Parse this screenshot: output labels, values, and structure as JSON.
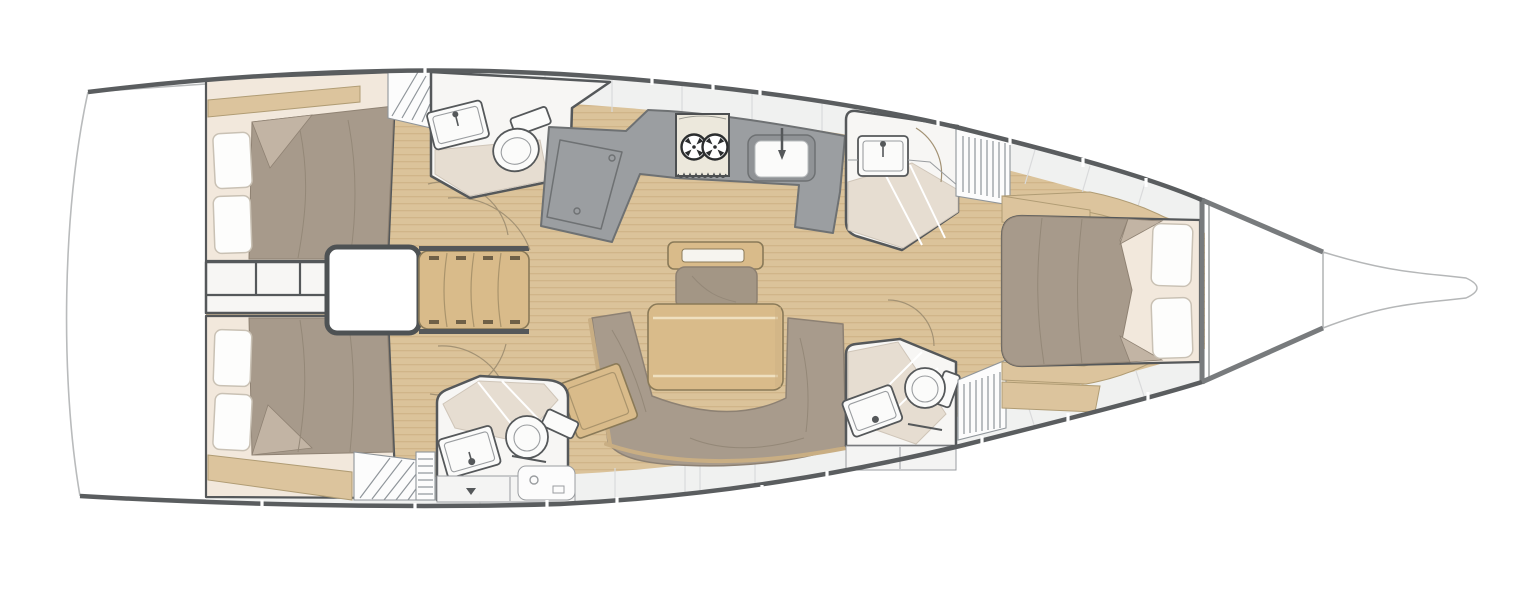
{
  "meta": {
    "title": "Sailing Yacht Interior Layout Plan",
    "view": "overhead-deck-plan",
    "orientation": "bow-right-stern-left",
    "canvas": {
      "width": 1529,
      "height": 600
    }
  },
  "summary": {
    "double_cabins": 3,
    "heads_with_shower": 4,
    "salon_tables": 1,
    "companionway_steps": 4,
    "stove_burners": 2
  },
  "legend": {
    "rooms": [
      {
        "id": "swim-platform",
        "label": "Stern swim platform"
      },
      {
        "id": "aft-cabin-port",
        "label": "Aft double cabin (port)"
      },
      {
        "id": "aft-cabin-starboard",
        "label": "Aft double cabin (starboard)"
      },
      {
        "id": "companionway",
        "label": "Companionway steps"
      },
      {
        "id": "head-port-aft",
        "label": "Head with shower (port aft)"
      },
      {
        "id": "galley",
        "label": "Galley with stove and sink"
      },
      {
        "id": "head-port-forward",
        "label": "Head with shower (port forward)"
      },
      {
        "id": "salon",
        "label": "Salon with U-shaped settee and table"
      },
      {
        "id": "head-starboard-aft",
        "label": "Head with shower (starboard aft)"
      },
      {
        "id": "head-starboard-forward",
        "label": "Head with shower (starboard forward)"
      },
      {
        "id": "forward-cabin",
        "label": "Forward owner's cabin"
      },
      {
        "id": "anchor-locker",
        "label": "Bow anchor locker"
      }
    ],
    "fixtures": [
      "toilet-icon",
      "sink-icon",
      "stove-icon",
      "galley-sink-icon",
      "fridge-icon",
      "table-icon",
      "settee-icon",
      "bed-icon",
      "pillow-icon",
      "steps-icon",
      "louvered-locker-icon",
      "door-swing-icon"
    ]
  },
  "colors": {
    "background": "#ffffff",
    "woodFloor": "#dbc39a",
    "woodLine": "#c7a97c",
    "woodFurniture": "#d9bb8a",
    "woodTrim": "#8a7a58",
    "tanShelf": "#dcc49d",
    "duvet": "#a79a8b",
    "duvetFold": "#c2b4a4",
    "duvetLine": "#948878",
    "mattress": "#f2e8dc",
    "pillow": "#fdfdfc",
    "pillowEdge": "#c9c1b4",
    "sofa": "#a89b8c",
    "sofaTrim": "#c9ae83",
    "counter": "#9b9ea1",
    "counterEdge": "#6e7173",
    "stove": "#ece8dc",
    "burner": "#2b2d2e",
    "fixtureWhite": "#fbfbfa",
    "fixtureEdge": "#55585a",
    "shower": "#e6ddd1",
    "showerEdge": "#cfc5b8",
    "room": "#f7f6f4",
    "wall": "#55585a",
    "hull": "#787b7d",
    "toerail": "#5a5d5f",
    "deck": "#f0f1f0",
    "deckSeam": "#d9dadb",
    "locker": "#fcfcfc",
    "lockerLine": "#8f959a",
    "arc": "#a39274",
    "transomLine": "#b9bbbc"
  }
}
